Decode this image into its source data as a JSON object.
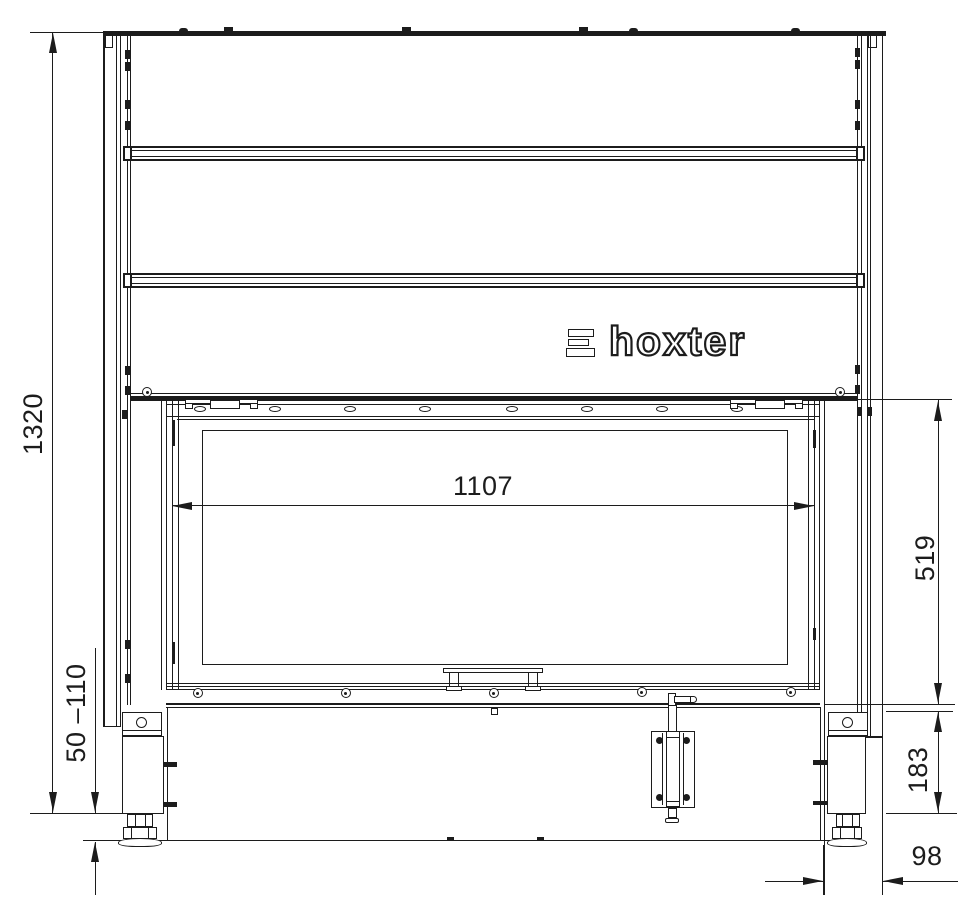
{
  "logo": {
    "text": "hoxter",
    "icon": "hoxter-triple-bar-icon"
  },
  "dimensions": {
    "overall_height": "1320",
    "glass_width": "1107",
    "door_height": "519",
    "base_height": "183",
    "foot_range": "50 –110",
    "side_offset": "98"
  },
  "colors": {
    "line": "#1c1c1c",
    "background": "#ffffff"
  }
}
